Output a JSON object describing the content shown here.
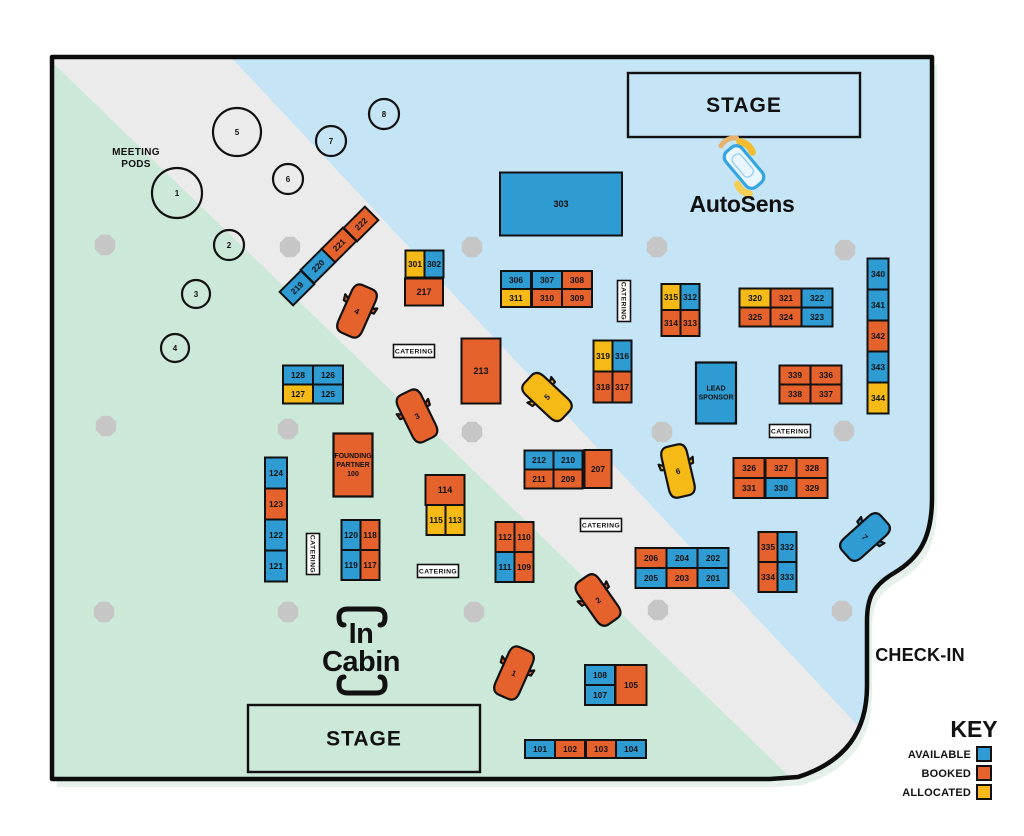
{
  "labels": {
    "check_in": "CHECK-IN",
    "meeting_pods_line1": "MEETING",
    "meeting_pods_line2": "PODS",
    "stage": "STAGE",
    "catering": "CATERING",
    "autosens": "AutoSens",
    "incabin_line1": "In",
    "incabin_line2": "Cabin"
  },
  "legend": {
    "title": "KEY",
    "items": [
      {
        "label": "AVAILABLE",
        "status": "available"
      },
      {
        "label": "BOOKED",
        "status": "booked"
      },
      {
        "label": "ALLOCATED",
        "status": "allocated"
      }
    ]
  },
  "colors": {
    "available": "#2e9bd3",
    "booked": "#e5622c",
    "allocated": "#f5ba16",
    "zone_blue": "#c5e4f5",
    "zone_green": "#cce8d8",
    "zone_gray": "#ebebeb",
    "pillar": "#c6c6c6",
    "ink": "#111111"
  },
  "booths": [
    {
      "id": "101",
      "status": "available",
      "cx": 540,
      "cy": 749,
      "w": 30,
      "h": 18
    },
    {
      "id": "102",
      "status": "booked",
      "cx": 570,
      "cy": 749,
      "w": 30,
      "h": 18
    },
    {
      "id": "103",
      "status": "booked",
      "cx": 601,
      "cy": 749,
      "w": 30,
      "h": 18
    },
    {
      "id": "104",
      "status": "available",
      "cx": 631,
      "cy": 749,
      "w": 30,
      "h": 18
    },
    {
      "id": "105",
      "status": "booked",
      "cx": 631,
      "cy": 685,
      "w": 31,
      "h": 40
    },
    {
      "id": "107",
      "status": "available",
      "cx": 600,
      "cy": 695,
      "w": 30,
      "h": 20
    },
    {
      "id": "108",
      "status": "available",
      "cx": 600,
      "cy": 675,
      "w": 30,
      "h": 20
    },
    {
      "id": "109",
      "status": "booked",
      "cx": 524,
      "cy": 567,
      "w": 19,
      "h": 30
    },
    {
      "id": "110",
      "status": "booked",
      "cx": 524,
      "cy": 537,
      "w": 19,
      "h": 30
    },
    {
      "id": "111",
      "status": "available",
      "cx": 505,
      "cy": 567,
      "w": 19,
      "h": 30
    },
    {
      "id": "112",
      "status": "booked",
      "cx": 505,
      "cy": 537,
      "w": 19,
      "h": 30
    },
    {
      "id": "113",
      "status": "allocated",
      "cx": 455,
      "cy": 520,
      "w": 19,
      "h": 30
    },
    {
      "id": "114",
      "status": "booked",
      "cx": 445,
      "cy": 490,
      "w": 39,
      "h": 30
    },
    {
      "id": "115",
      "status": "allocated",
      "cx": 436,
      "cy": 520,
      "w": 19,
      "h": 30
    },
    {
      "id": "117",
      "status": "booked",
      "cx": 370,
      "cy": 565,
      "w": 19,
      "h": 30
    },
    {
      "id": "118",
      "status": "booked",
      "cx": 370,
      "cy": 535,
      "w": 19,
      "h": 30
    },
    {
      "id": "119",
      "status": "available",
      "cx": 351,
      "cy": 565,
      "w": 19,
      "h": 30
    },
    {
      "id": "120",
      "status": "available",
      "cx": 351,
      "cy": 535,
      "w": 19,
      "h": 30
    },
    {
      "id": "121",
      "status": "available",
      "cx": 276,
      "cy": 566,
      "w": 22,
      "h": 31
    },
    {
      "id": "122",
      "status": "available",
      "cx": 276,
      "cy": 535,
      "w": 22,
      "h": 31
    },
    {
      "id": "123",
      "status": "booked",
      "cx": 276,
      "cy": 504,
      "w": 22,
      "h": 31
    },
    {
      "id": "124",
      "status": "available",
      "cx": 276,
      "cy": 473,
      "w": 22,
      "h": 31
    },
    {
      "id": "125",
      "status": "available",
      "cx": 328,
      "cy": 394,
      "w": 30,
      "h": 19
    },
    {
      "id": "126",
      "status": "available",
      "cx": 328,
      "cy": 375,
      "w": 30,
      "h": 19
    },
    {
      "id": "127",
      "status": "allocated",
      "cx": 298,
      "cy": 394,
      "w": 30,
      "h": 19
    },
    {
      "id": "128",
      "status": "available",
      "cx": 298,
      "cy": 375,
      "w": 30,
      "h": 19
    },
    {
      "id": "201",
      "status": "available",
      "cx": 713,
      "cy": 578,
      "w": 31,
      "h": 20
    },
    {
      "id": "202",
      "status": "available",
      "cx": 713,
      "cy": 558,
      "w": 31,
      "h": 20
    },
    {
      "id": "203",
      "status": "booked",
      "cx": 682,
      "cy": 578,
      "w": 31,
      "h": 20
    },
    {
      "id": "204",
      "status": "available",
      "cx": 682,
      "cy": 558,
      "w": 31,
      "h": 20
    },
    {
      "id": "205",
      "status": "available",
      "cx": 651,
      "cy": 578,
      "w": 31,
      "h": 20
    },
    {
      "id": "206",
      "status": "booked",
      "cx": 651,
      "cy": 558,
      "w": 31,
      "h": 20
    },
    {
      "id": "207",
      "status": "booked",
      "cx": 598,
      "cy": 469,
      "w": 27,
      "h": 38
    },
    {
      "id": "209",
      "status": "booked",
      "cx": 568,
      "cy": 479,
      "w": 29,
      "h": 19
    },
    {
      "id": "210",
      "status": "available",
      "cx": 568,
      "cy": 460,
      "w": 29,
      "h": 19
    },
    {
      "id": "211",
      "status": "booked",
      "cx": 539,
      "cy": 479,
      "w": 29,
      "h": 19
    },
    {
      "id": "212",
      "status": "available",
      "cx": 539,
      "cy": 460,
      "w": 29,
      "h": 19
    },
    {
      "id": "213",
      "status": "booked",
      "cx": 481,
      "cy": 371,
      "w": 39,
      "h": 65
    },
    {
      "id": "217",
      "status": "booked",
      "cx": 424,
      "cy": 292,
      "w": 38,
      "h": 27
    },
    {
      "id": "219",
      "status": "available",
      "cx": 297,
      "cy": 288,
      "w": 30,
      "h": 19,
      "rot": -45
    },
    {
      "id": "220",
      "status": "available",
      "cx": 318,
      "cy": 266,
      "w": 30,
      "h": 19,
      "rot": -45
    },
    {
      "id": "221",
      "status": "booked",
      "cx": 339,
      "cy": 245,
      "w": 30,
      "h": 19,
      "rot": -45
    },
    {
      "id": "222",
      "status": "booked",
      "cx": 361,
      "cy": 224,
      "w": 30,
      "h": 19,
      "rot": -45
    },
    {
      "id": "301",
      "status": "allocated",
      "cx": 415,
      "cy": 264,
      "w": 19,
      "h": 27
    },
    {
      "id": "302",
      "status": "available",
      "cx": 434,
      "cy": 264,
      "w": 19,
      "h": 27
    },
    {
      "id": "303",
      "status": "available",
      "cx": 561,
      "cy": 204,
      "w": 122,
      "h": 63
    },
    {
      "id": "306",
      "status": "available",
      "cx": 516,
      "cy": 280,
      "w": 30,
      "h": 18
    },
    {
      "id": "307",
      "status": "available",
      "cx": 547,
      "cy": 280,
      "w": 30,
      "h": 18
    },
    {
      "id": "308",
      "status": "booked",
      "cx": 577,
      "cy": 280,
      "w": 30,
      "h": 18
    },
    {
      "id": "309",
      "status": "booked",
      "cx": 577,
      "cy": 298,
      "w": 30,
      "h": 18
    },
    {
      "id": "310",
      "status": "booked",
      "cx": 547,
      "cy": 298,
      "w": 30,
      "h": 18
    },
    {
      "id": "311",
      "status": "allocated",
      "cx": 516,
      "cy": 298,
      "w": 30,
      "h": 18
    },
    {
      "id": "312",
      "status": "available",
      "cx": 690,
      "cy": 297,
      "w": 19,
      "h": 26
    },
    {
      "id": "313",
      "status": "booked",
      "cx": 690,
      "cy": 323,
      "w": 19,
      "h": 26
    },
    {
      "id": "314",
      "status": "booked",
      "cx": 671,
      "cy": 323,
      "w": 19,
      "h": 26
    },
    {
      "id": "315",
      "status": "allocated",
      "cx": 671,
      "cy": 297,
      "w": 19,
      "h": 26
    },
    {
      "id": "316",
      "status": "available",
      "cx": 622,
      "cy": 356,
      "w": 19,
      "h": 31
    },
    {
      "id": "317",
      "status": "booked",
      "cx": 622,
      "cy": 387,
      "w": 19,
      "h": 31
    },
    {
      "id": "318",
      "status": "booked",
      "cx": 603,
      "cy": 387,
      "w": 19,
      "h": 31
    },
    {
      "id": "319",
      "status": "allocated",
      "cx": 603,
      "cy": 356,
      "w": 19,
      "h": 31
    },
    {
      "id": "320",
      "status": "allocated",
      "cx": 755,
      "cy": 298,
      "w": 31,
      "h": 19
    },
    {
      "id": "321",
      "status": "booked",
      "cx": 786,
      "cy": 298,
      "w": 31,
      "h": 19
    },
    {
      "id": "322",
      "status": "available",
      "cx": 817,
      "cy": 298,
      "w": 31,
      "h": 19
    },
    {
      "id": "323",
      "status": "available",
      "cx": 817,
      "cy": 317,
      "w": 31,
      "h": 19
    },
    {
      "id": "324",
      "status": "booked",
      "cx": 786,
      "cy": 317,
      "w": 31,
      "h": 19
    },
    {
      "id": "325",
      "status": "booked",
      "cx": 755,
      "cy": 317,
      "w": 31,
      "h": 19
    },
    {
      "id": "326",
      "status": "booked",
      "cx": 749,
      "cy": 468,
      "w": 31,
      "h": 20
    },
    {
      "id": "327",
      "status": "booked",
      "cx": 781,
      "cy": 468,
      "w": 31,
      "h": 20
    },
    {
      "id": "328",
      "status": "booked",
      "cx": 812,
      "cy": 468,
      "w": 31,
      "h": 20
    },
    {
      "id": "329",
      "status": "booked",
      "cx": 812,
      "cy": 488,
      "w": 31,
      "h": 20
    },
    {
      "id": "330",
      "status": "available",
      "cx": 781,
      "cy": 488,
      "w": 31,
      "h": 20
    },
    {
      "id": "331",
      "status": "booked",
      "cx": 749,
      "cy": 488,
      "w": 31,
      "h": 20
    },
    {
      "id": "332",
      "status": "available",
      "cx": 787,
      "cy": 547,
      "w": 19,
      "h": 30
    },
    {
      "id": "333",
      "status": "available",
      "cx": 787,
      "cy": 577,
      "w": 19,
      "h": 30
    },
    {
      "id": "334",
      "status": "booked",
      "cx": 768,
      "cy": 577,
      "w": 19,
      "h": 30
    },
    {
      "id": "335",
      "status": "booked",
      "cx": 768,
      "cy": 547,
      "w": 19,
      "h": 30
    },
    {
      "id": "336",
      "status": "booked",
      "cx": 826,
      "cy": 375,
      "w": 31,
      "h": 19
    },
    {
      "id": "337",
      "status": "booked",
      "cx": 826,
      "cy": 394,
      "w": 31,
      "h": 19
    },
    {
      "id": "338",
      "status": "booked",
      "cx": 795,
      "cy": 394,
      "w": 31,
      "h": 19
    },
    {
      "id": "339",
      "status": "booked",
      "cx": 795,
      "cy": 375,
      "w": 31,
      "h": 19
    },
    {
      "id": "340",
      "status": "available",
      "cx": 878,
      "cy": 274,
      "w": 21,
      "h": 31
    },
    {
      "id": "341",
      "status": "available",
      "cx": 878,
      "cy": 305,
      "w": 21,
      "h": 31
    },
    {
      "id": "342",
      "status": "booked",
      "cx": 878,
      "cy": 336,
      "w": 21,
      "h": 31
    },
    {
      "id": "343",
      "status": "available",
      "cx": 878,
      "cy": 367,
      "w": 21,
      "h": 31
    },
    {
      "id": "344",
      "status": "allocated",
      "cx": 878,
      "cy": 398,
      "w": 21,
      "h": 31
    }
  ],
  "labeled_booths": [
    {
      "lines": [
        "FOUNDING",
        "PARTNER",
        "100"
      ],
      "status": "booked",
      "cx": 353,
      "cy": 465,
      "w": 39,
      "h": 63
    },
    {
      "lines": [
        "LEAD",
        "SPONSOR"
      ],
      "status": "available",
      "cx": 716,
      "cy": 393,
      "w": 40,
      "h": 61
    }
  ],
  "pods": [
    {
      "n": "1",
      "cx": 177,
      "cy": 193,
      "r": 25
    },
    {
      "n": "2",
      "cx": 229,
      "cy": 245,
      "r": 15
    },
    {
      "n": "3",
      "cx": 196,
      "cy": 294,
      "r": 14
    },
    {
      "n": "4",
      "cx": 175,
      "cy": 348,
      "r": 14
    },
    {
      "n": "5",
      "cx": 237,
      "cy": 132,
      "r": 24
    },
    {
      "n": "6",
      "cx": 288,
      "cy": 179,
      "r": 15
    },
    {
      "n": "7",
      "cx": 331,
      "cy": 141,
      "r": 15
    },
    {
      "n": "8",
      "cx": 384,
      "cy": 114,
      "r": 15
    }
  ],
  "cars": [
    {
      "n": "1",
      "status": "booked",
      "cx": 514,
      "cy": 673,
      "rot": 24
    },
    {
      "n": "2",
      "status": "booked",
      "cx": 598,
      "cy": 600,
      "rot": -35
    },
    {
      "n": "3",
      "status": "booked",
      "cx": 417,
      "cy": 416,
      "rot": -26
    },
    {
      "n": "4",
      "status": "booked",
      "cx": 357,
      "cy": 311,
      "rot": 24
    },
    {
      "n": "5",
      "status": "allocated",
      "cx": 547,
      "cy": 397,
      "rot": -47
    },
    {
      "n": "6",
      "status": "allocated",
      "cx": 678,
      "cy": 471,
      "rot": -13
    },
    {
      "n": "7",
      "status": "available",
      "cx": 865,
      "cy": 537,
      "rot": 48
    }
  ],
  "pillars": [
    [
      105,
      245
    ],
    [
      290,
      247
    ],
    [
      472,
      247
    ],
    [
      657,
      247
    ],
    [
      845,
      250
    ],
    [
      106,
      426
    ],
    [
      288,
      429
    ],
    [
      472,
      432
    ],
    [
      662,
      432
    ],
    [
      844,
      431
    ],
    [
      104,
      612
    ],
    [
      288,
      612
    ],
    [
      474,
      612
    ],
    [
      658,
      610
    ],
    [
      842,
      611
    ]
  ],
  "stages": [
    {
      "x": 628,
      "y": 73,
      "w": 232,
      "h": 64
    },
    {
      "x": 248,
      "y": 705,
      "w": 232,
      "h": 67
    }
  ],
  "catering": [
    {
      "cx": 414,
      "cy": 351,
      "vertical": false
    },
    {
      "cx": 624,
      "cy": 301,
      "vertical": true
    },
    {
      "cx": 790,
      "cy": 431,
      "vertical": false
    },
    {
      "cx": 601,
      "cy": 525,
      "vertical": false
    },
    {
      "cx": 313,
      "cy": 554,
      "vertical": true
    },
    {
      "cx": 438,
      "cy": 571,
      "vertical": false
    }
  ]
}
